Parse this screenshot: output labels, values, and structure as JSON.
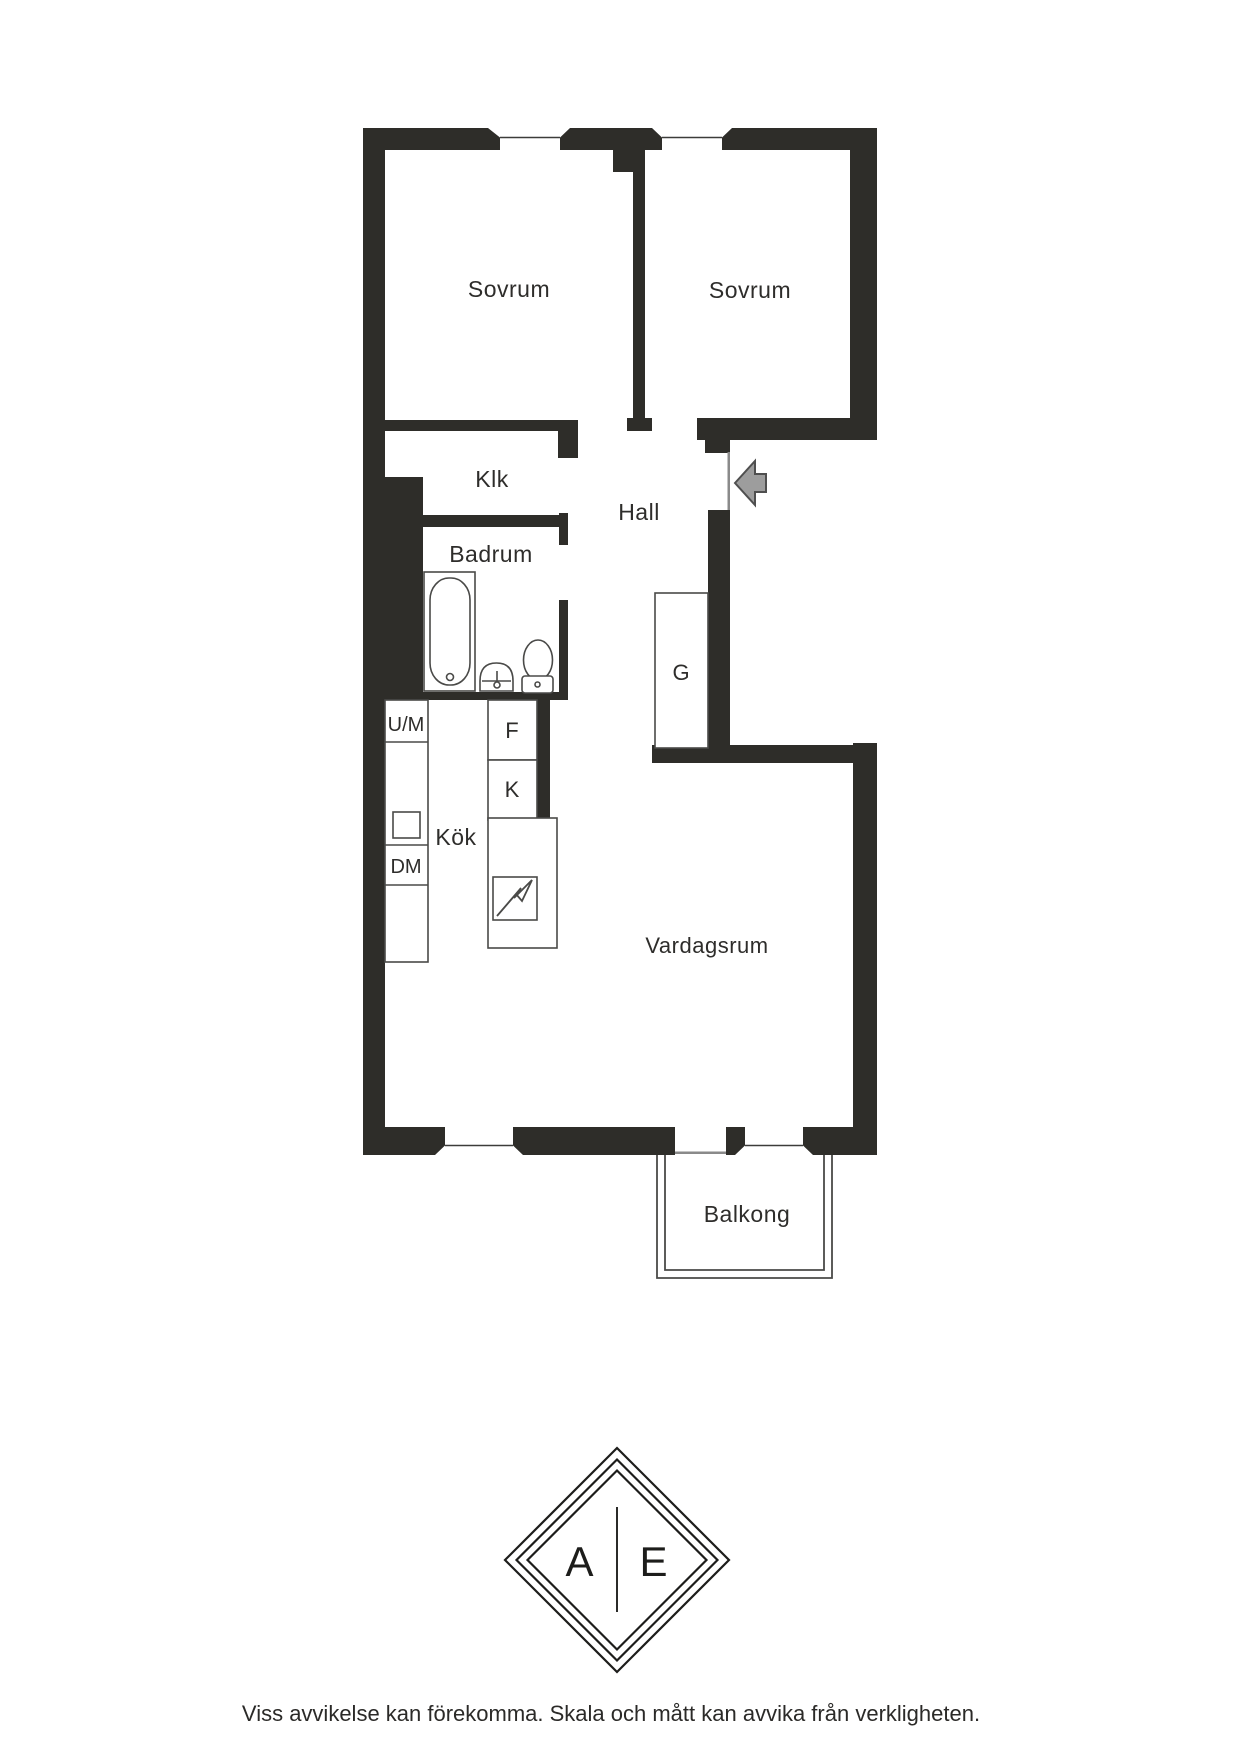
{
  "title": "Apartment floor plan",
  "rooms": {
    "sovrum1": "Sovrum",
    "sovrum2": "Sovrum",
    "klk": "Klk",
    "hall": "Hall",
    "badrum": "Badrum",
    "kok": "Kök",
    "vardagsrum": "Vardagsrum",
    "balkong": "Balkong",
    "wardrobe": "G"
  },
  "appliances": {
    "um": "U/M",
    "f": "F",
    "k": "K",
    "dm": "DM"
  },
  "logo": {
    "left": "A",
    "right": "E"
  },
  "disclaimer": "Viss avvikelse kan förekomma. Skala och mått kan avvika från verkligheten.",
  "colors": {
    "wall": "#2e2d29",
    "fixture_line": "#4a4a48",
    "text": "#2e2d2b",
    "arrow_fill": "#9d9d9d",
    "arrow_stroke": "#4f4f4f",
    "background": "#ffffff"
  }
}
